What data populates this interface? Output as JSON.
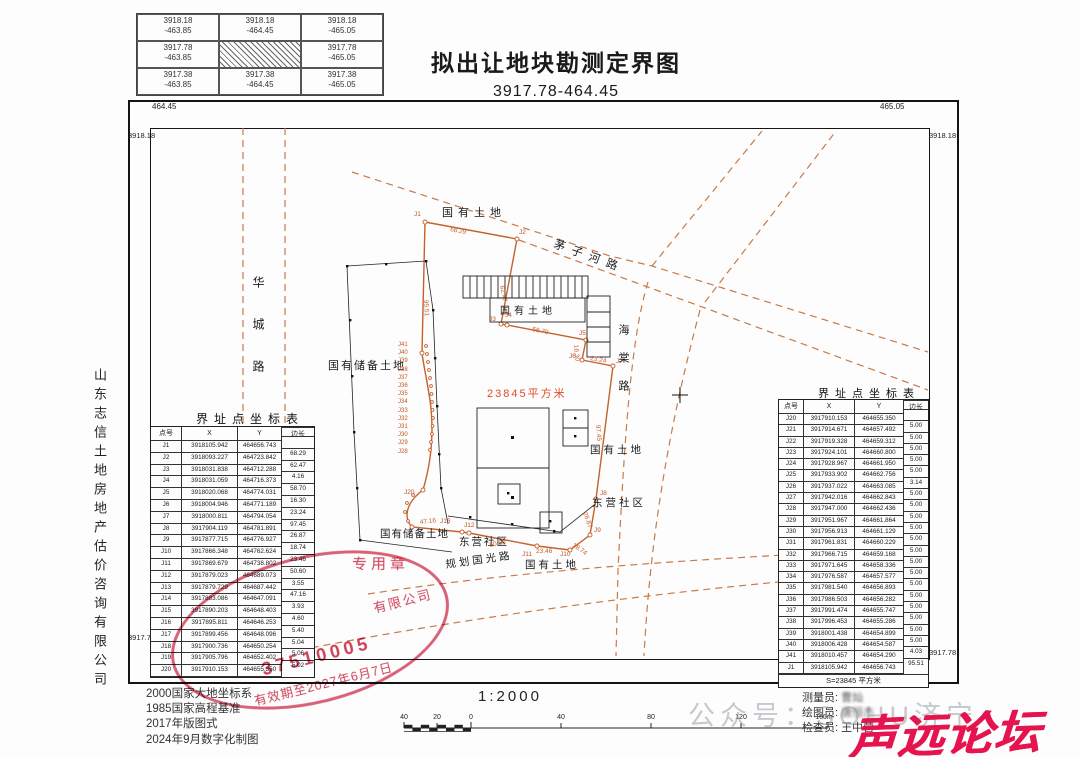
{
  "page": {
    "title": "拟出让地块勘测定界图",
    "subtitle": "3917.78-464.45"
  },
  "grid_table": {
    "cells": [
      [
        "3918.18",
        "-463.85"
      ],
      [
        "3918.18",
        "-464.45"
      ],
      [
        "3918.18",
        "-465.05"
      ],
      [
        "3917.78",
        "-463.85"
      ],
      [
        "",
        ""
      ],
      [
        "3917.78",
        "-465.05"
      ],
      [
        "3917.38",
        "-463.85"
      ],
      [
        "3917.38",
        "-464.45"
      ],
      [
        "3917.38",
        "-465.05"
      ]
    ]
  },
  "frame": {
    "tl_top": "464.45",
    "tl_left": "3918.18",
    "tr_top": "465.05",
    "tr_right": "3918.18",
    "bl_left": "3917.78",
    "bl_bottom": "464.45",
    "br_right": "3917.78",
    "br_bottom": "465.05"
  },
  "company_vertical": "山东志信土地房地产估价咨询有限公司",
  "map": {
    "area": "23845平方米",
    "labels": {
      "state_land_top": "国有土地",
      "maozihe_road": "茅子河路",
      "huacheng_road": "华城路",
      "reserve_left": "国有储备土地",
      "state_land_bldg": "国有土地",
      "haitang_road": "海棠路",
      "state_land_right": "国有土地",
      "dongying_right": "东营社区",
      "reserve_bottom": "国有储备土地",
      "dongying_bottom": "东营社区",
      "planned_road": "规划国光路",
      "state_land_bottom": "国有土地"
    },
    "jpoints": {
      "j1": "J1",
      "j2": "J2",
      "j3": "J3",
      "j4": "J4",
      "j5": "J5",
      "j6": "J6",
      "j7": "J7",
      "j8": "J8",
      "j9": "J9",
      "j10": "J10",
      "j11": "J11",
      "j12": "J12",
      "j13": "J13",
      "j20": "J20",
      "cluster": "J41\nJ40\nJ39\nJ38\nJ37\nJ36\nJ35\nJ34\nJ33\nJ32\nJ31\nJ30\nJ29\nJ28"
    },
    "edges": {
      "e1": "68.29",
      "e95": "95.51",
      "e2": "62.47",
      "e4": "58.70",
      "e5": "16.30",
      "e6": "23.24",
      "e7": "97.45",
      "e8": "26.87",
      "e9": "18.74",
      "e10": "23.46",
      "e11": "50.60",
      "e12": "47.16"
    }
  },
  "left_table": {
    "title": "界址点坐标表",
    "headers": [
      "点号",
      "X",
      "Y",
      "边长"
    ],
    "rows": [
      [
        "J1",
        "3918105.942",
        "464656.743",
        ""
      ],
      [
        "J2",
        "3918093.227",
        "464723.842",
        "68.29"
      ],
      [
        "J3",
        "3918031.838",
        "464712.288",
        "62.47"
      ],
      [
        "J4",
        "3918031.059",
        "464716.373",
        "4.16"
      ],
      [
        "J5",
        "3918020.068",
        "464774.031",
        "58.70"
      ],
      [
        "J6",
        "3918004.946",
        "464771.189",
        "16.30"
      ],
      [
        "J7",
        "3918000.811",
        "464794.054",
        "23.24"
      ],
      [
        "J8",
        "3917904.119",
        "464781.891",
        "97.45"
      ],
      [
        "J9",
        "3917877.715",
        "464776.927",
        "26.87"
      ],
      [
        "J10",
        "3917866.348",
        "464762.624",
        "18.74"
      ],
      [
        "J11",
        "3917869.679",
        "464738.802",
        "23.46"
      ],
      [
        "J12",
        "3917879.023",
        "464689.073",
        "50.60"
      ],
      [
        "J13",
        "3917879.729",
        "464687.442",
        "3.55"
      ],
      [
        "J14",
        "3917883.086",
        "464647.091",
        "47.16"
      ],
      [
        "J15",
        "3917890.203",
        "464648.403",
        "3.93"
      ],
      [
        "J16",
        "3917895.811",
        "464646.253",
        "4.60"
      ],
      [
        "J17",
        "3917899.456",
        "464648.096",
        "5.40"
      ],
      [
        "J18",
        "3917900.736",
        "464650.254",
        "5.04"
      ],
      [
        "J19",
        "3917905.796",
        "464652.402",
        "5.06"
      ],
      [
        "J20",
        "3917910.153",
        "464655.350",
        "5.02"
      ]
    ]
  },
  "right_table": {
    "title": "界址点坐标表",
    "headers": [
      "点号",
      "X",
      "Y",
      "边长"
    ],
    "rows": [
      [
        "J20",
        "3917910.153",
        "464655.350",
        ""
      ],
      [
        "J21",
        "3917914.671",
        "464657.492",
        "5.00"
      ],
      [
        "J22",
        "3917919.328",
        "464659.312",
        "5.00"
      ],
      [
        "J23",
        "3917924.101",
        "464660.800",
        "5.00"
      ],
      [
        "J24",
        "3917928.967",
        "464661.950",
        "5.00"
      ],
      [
        "J25",
        "3917933.902",
        "464662.756",
        "5.00"
      ],
      [
        "J26",
        "3917937.022",
        "464663.085",
        "3.14"
      ],
      [
        "J27",
        "3917942.016",
        "464662.843",
        "5.00"
      ],
      [
        "J28",
        "3917947.000",
        "464662.436",
        "5.00"
      ],
      [
        "J29",
        "3917951.967",
        "464661.864",
        "5.00"
      ],
      [
        "J30",
        "3917956.913",
        "464661.129",
        "5.00"
      ],
      [
        "J31",
        "3917961.831",
        "464660.229",
        "5.00"
      ],
      [
        "J32",
        "3917966.715",
        "464659.168",
        "5.00"
      ],
      [
        "J33",
        "3917971.645",
        "464658.336",
        "5.00"
      ],
      [
        "J34",
        "3917976.587",
        "464657.577",
        "5.00"
      ],
      [
        "J35",
        "3917981.540",
        "464656.893",
        "5.00"
      ],
      [
        "J36",
        "3917986.503",
        "464656.282",
        "5.00"
      ],
      [
        "J37",
        "3917991.474",
        "464655.747",
        "5.00"
      ],
      [
        "J38",
        "3917996.453",
        "464655.286",
        "5.00"
      ],
      [
        "J39",
        "3918001.438",
        "464654.899",
        "5.00"
      ],
      [
        "J40",
        "3918006.428",
        "464654.587",
        "5.00"
      ],
      [
        "J41",
        "3918010.457",
        "464654.290",
        "4.03"
      ],
      [
        "J1",
        "3918105.942",
        "464656.743",
        "95.51"
      ]
    ],
    "footer": "S=23845 平方米"
  },
  "stamp": {
    "top": "专用章",
    "company": "有限公司",
    "number": "37510005",
    "validity": "有效期至2027年6月7日"
  },
  "notes": {
    "l1": "2000国家大地坐标系",
    "l2": "1985国家高程基准",
    "l3": "2017年版图式",
    "l4": "2024年9月数字化制图"
  },
  "scale": {
    "text": "1:2000",
    "ticks": [
      "40",
      "20",
      "0",
      "40",
      "80",
      "120",
      "160m"
    ]
  },
  "staff": {
    "l1": "测量员:",
    "n1": "曹灿",
    "l2": "绘图员:",
    "n2": "唐恒杰",
    "l3": "检查员:",
    "n3": "王中营"
  },
  "watermark": "公众号：SOHU济宁",
  "logo": "声远论坛"
}
